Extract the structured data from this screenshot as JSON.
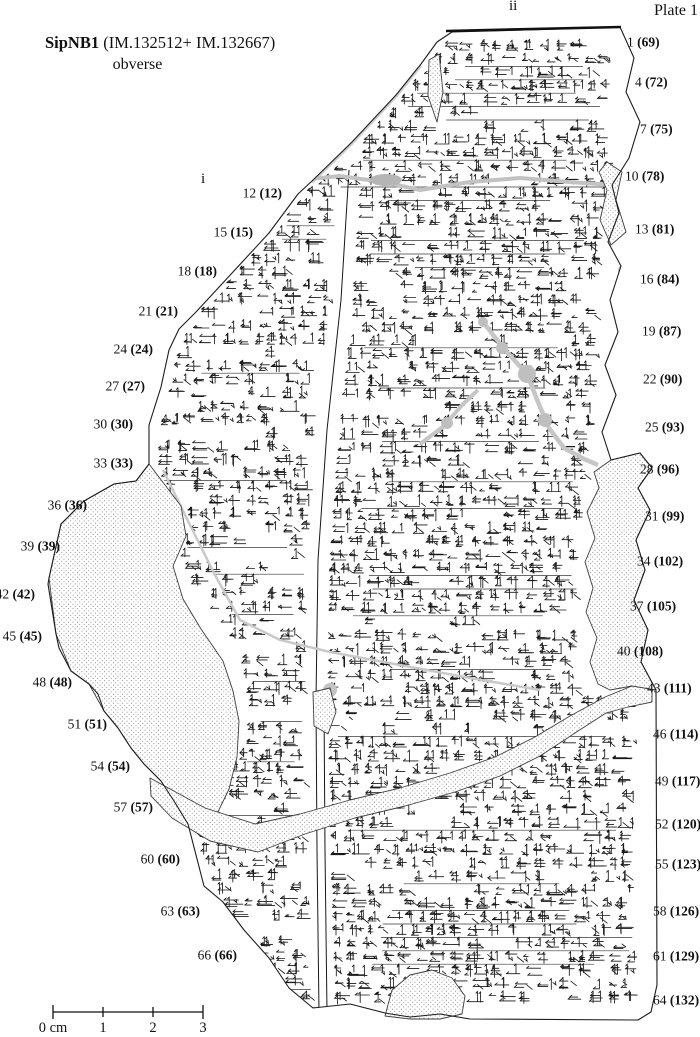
{
  "header": {
    "title_bold": "SipNB1",
    "title_rest": " (IM.132512+ IM.132667)",
    "subtitle": "obverse",
    "plate_label": "Plate 1"
  },
  "column_markers": {
    "col_i": "i",
    "col_ii": "ii"
  },
  "line_numbers": {
    "left": [
      {
        "line": "12",
        "paren": "(12)"
      },
      {
        "line": "15",
        "paren": "(15)"
      },
      {
        "line": "18",
        "paren": "(18)"
      },
      {
        "line": "21",
        "paren": "(21)"
      },
      {
        "line": "24",
        "paren": "(24)"
      },
      {
        "line": "27",
        "paren": "(27)"
      },
      {
        "line": "30",
        "paren": "(30)"
      },
      {
        "line": "33",
        "paren": "(33)"
      },
      {
        "line": "36",
        "paren": "(36)"
      },
      {
        "line": "39",
        "paren": "(39)"
      },
      {
        "line": "42",
        "paren": "(42)"
      },
      {
        "line": "45",
        "paren": "(45)"
      },
      {
        "line": "48",
        "paren": "(48)"
      },
      {
        "line": "51",
        "paren": "(51)"
      },
      {
        "line": "54",
        "paren": "(54)"
      },
      {
        "line": "57",
        "paren": "(57)"
      },
      {
        "line": "60",
        "paren": "(60)"
      },
      {
        "line": "63",
        "paren": "(63)"
      },
      {
        "line": "66",
        "paren": "(66)"
      }
    ],
    "right": [
      {
        "line": "1",
        "paren": "(69)"
      },
      {
        "line": "4",
        "paren": "(72)"
      },
      {
        "line": "7",
        "paren": "(75)"
      },
      {
        "line": "10",
        "paren": "(78)"
      },
      {
        "line": "13",
        "paren": "(81)"
      },
      {
        "line": "16",
        "paren": "(84)"
      },
      {
        "line": "19",
        "paren": "(87)"
      },
      {
        "line": "22",
        "paren": "(90)"
      },
      {
        "line": "25",
        "paren": "(93)"
      },
      {
        "line": "28",
        "paren": "(96)"
      },
      {
        "line": "31",
        "paren": "(99)"
      },
      {
        "line": "34",
        "paren": "(102)"
      },
      {
        "line": "37",
        "paren": "(105)"
      },
      {
        "line": "40",
        "paren": "(108)"
      },
      {
        "line": "43",
        "paren": "(111)"
      },
      {
        "line": "46",
        "paren": "(114)"
      },
      {
        "line": "49",
        "paren": "(117)"
      },
      {
        "line": "52",
        "paren": "(120)"
      },
      {
        "line": "55",
        "paren": "(123)"
      },
      {
        "line": "58",
        "paren": "(126)"
      },
      {
        "line": "61",
        "paren": "(129)"
      },
      {
        "line": "64",
        "paren": "(132)"
      }
    ]
  },
  "scale_bar": {
    "labels": [
      "0 cm",
      "1",
      "2",
      "3"
    ]
  }
}
